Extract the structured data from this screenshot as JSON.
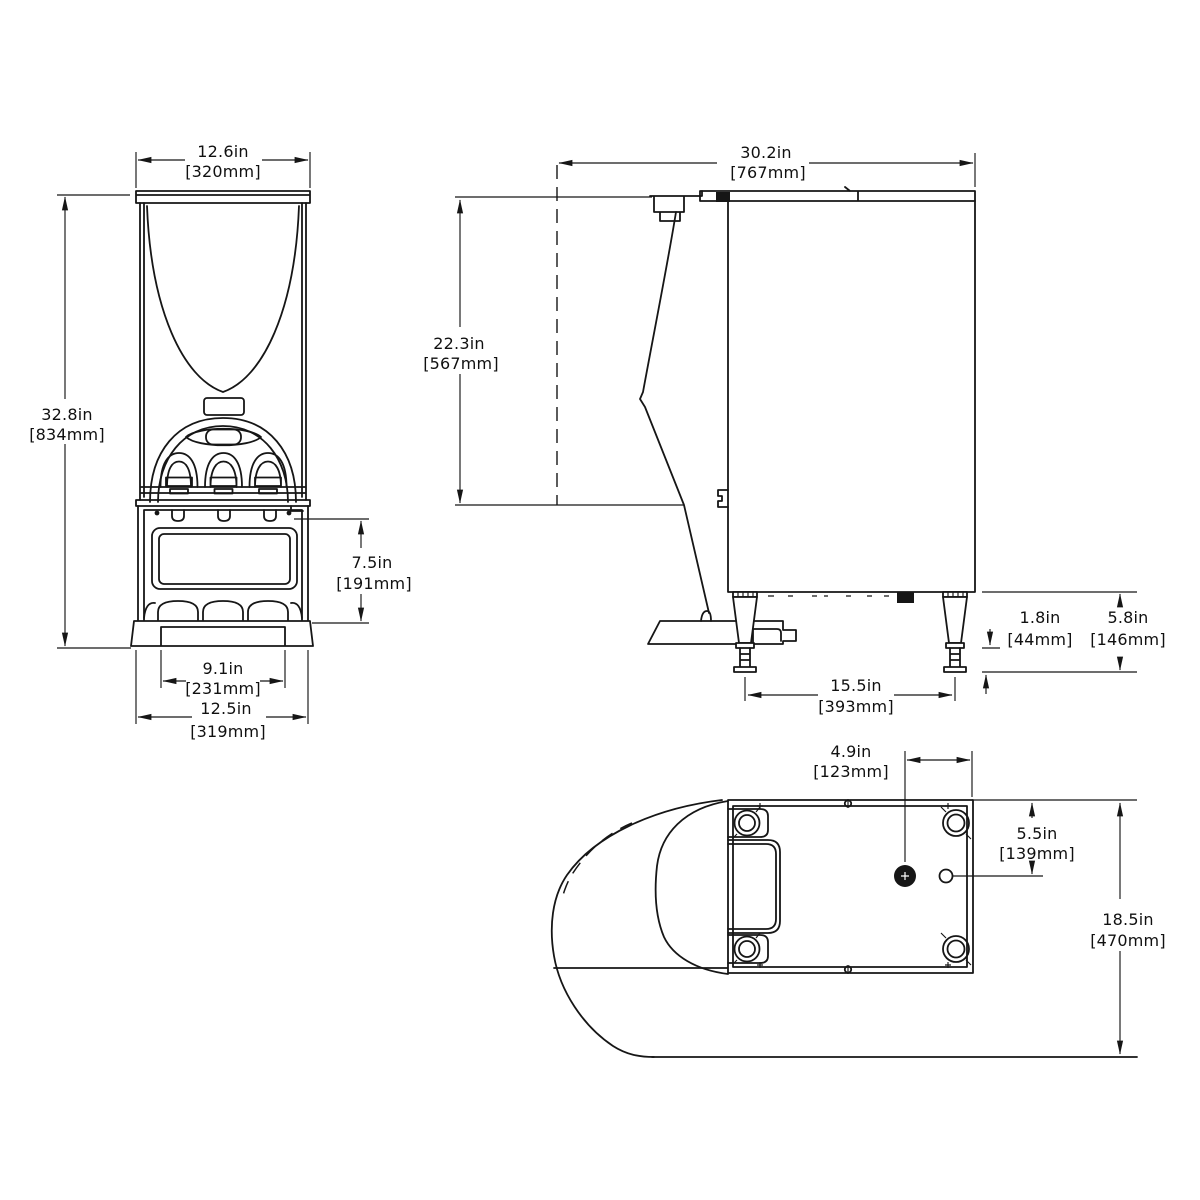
{
  "colors": {
    "line": "#161616",
    "background": "#ffffff"
  },
  "drawing": {
    "front_view": {
      "width": {
        "in": "12.6in",
        "mm": "[320mm]"
      },
      "height": {
        "in": "32.8in",
        "mm": "[834mm]"
      },
      "dispense_opening": {
        "in": "7.5in",
        "mm": "[191mm]"
      },
      "base_inner_width": {
        "in": "9.1in",
        "mm": "[231mm]"
      },
      "base_width": {
        "in": "12.5in",
        "mm": "[319mm]"
      }
    },
    "side_view": {
      "overall_depth": {
        "in": "30.2in",
        "mm": "[767mm]"
      },
      "height_to_counter": {
        "in": "22.3in",
        "mm": "[567mm]"
      },
      "foot_thread": {
        "in": "1.8in",
        "mm": "[44mm]"
      },
      "leg_height": {
        "in": "5.8in",
        "mm": "[146mm]"
      },
      "leg_spacing": {
        "in": "15.5in",
        "mm": "[393mm]"
      }
    },
    "bottom_view": {
      "drain_offset_side": {
        "in": "4.9in",
        "mm": "[123mm]"
      },
      "drain_offset_rear": {
        "in": "5.5in",
        "mm": "[139mm]"
      },
      "footprint_depth": {
        "in": "18.5in",
        "mm": "[470mm]"
      }
    }
  }
}
